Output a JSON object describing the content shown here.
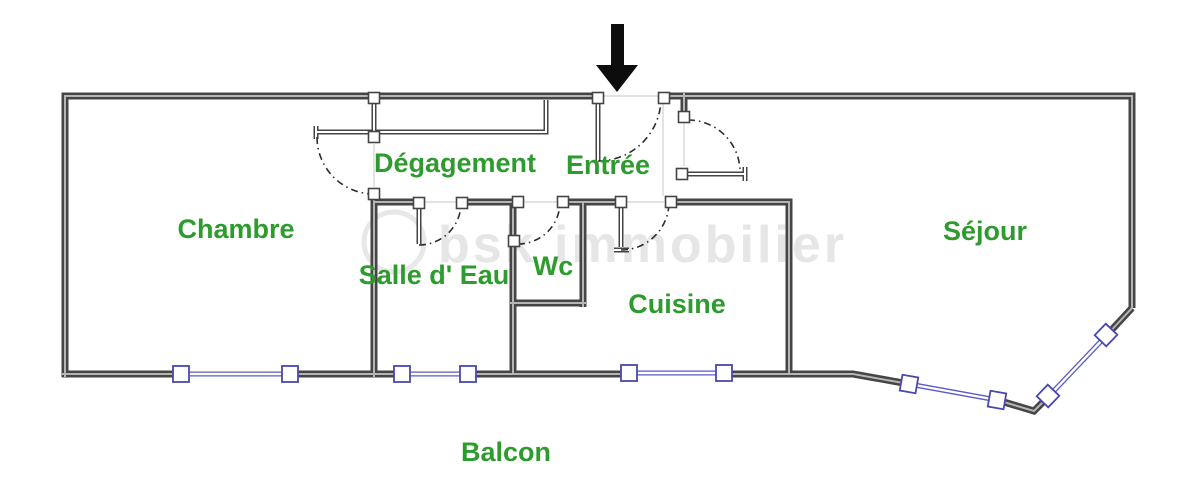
{
  "rooms": {
    "chambre": {
      "label": "Chambre"
    },
    "degagement": {
      "label": "Dégagement"
    },
    "entree": {
      "label": "Entrée"
    },
    "salle_deau": {
      "label": "Salle d' Eau"
    },
    "wc": {
      "label": "Wc"
    },
    "cuisine": {
      "label": "Cuisine"
    },
    "sejour": {
      "label": "Séjour"
    },
    "balcon": {
      "label": "Balcon"
    }
  },
  "watermark": {
    "text": "bsk immobilier"
  },
  "icons": {
    "entrance_arrow": "down-arrow-icon"
  },
  "colors": {
    "label_green": "#2e9b2e",
    "window_blue": "#5a5ac6",
    "wall_dark": "#454545",
    "wall_core": "#b5b5b5",
    "arc_dark": "#2d2d2d",
    "guide_gray": "#d8d8d8",
    "background": "#ffffff",
    "arrow_black": "#0d0d0d",
    "watermark_gray": "#d2d2d2"
  }
}
